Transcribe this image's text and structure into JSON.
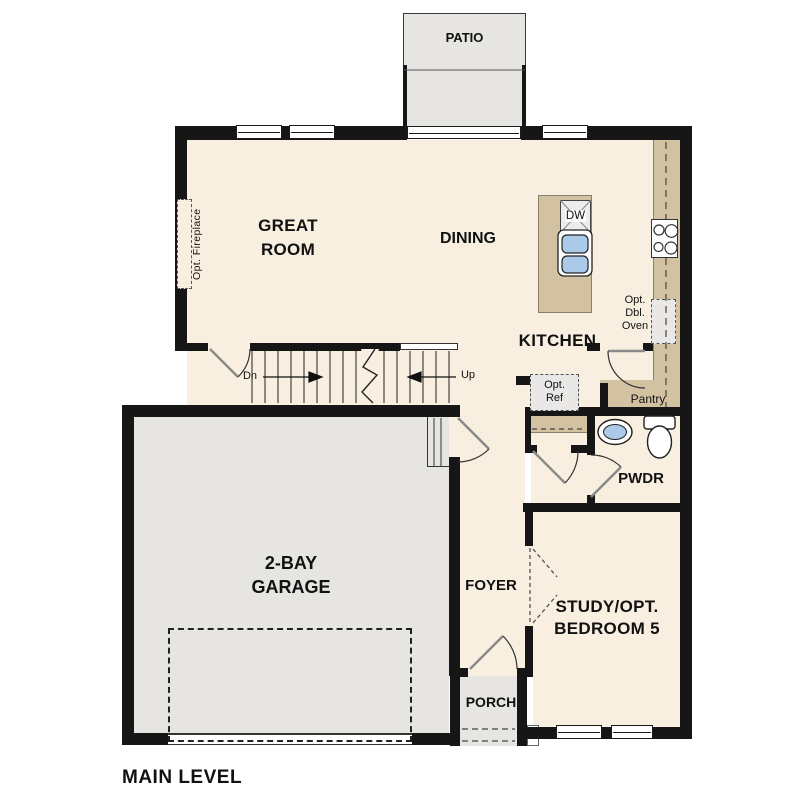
{
  "title": "MAIN LEVEL",
  "colors": {
    "wall": "#161616",
    "floor": "#f8efe1",
    "concrete": "#e6e5e2",
    "counter_tan": "#d2c2a2",
    "sink_blue": "#abc9e9",
    "fixture_gray": "#e9e8e6"
  },
  "rooms": {
    "patio": {
      "label": "PATIO"
    },
    "great_room": {
      "label": "GREAT\nROOM"
    },
    "dining": {
      "label": "DINING"
    },
    "kitchen": {
      "label": "KITCHEN"
    },
    "garage": {
      "label": "2-BAY\nGARAGE"
    },
    "foyer": {
      "label": "FOYER"
    },
    "study": {
      "label": "STUDY/OPT.\nBEDROOM 5"
    },
    "powder": {
      "label": "PWDR"
    },
    "porch": {
      "label": "PORCH"
    },
    "pantry": {
      "label": "Pantry"
    }
  },
  "annotations": {
    "opt_fireplace": "Opt. Fireplace",
    "opt_ref": "Opt.\nRef",
    "opt_dbl_oven": "Opt.\nDbl.\nOven",
    "dishwasher": "DW",
    "stairs_down": "Dn",
    "stairs_up": "Up",
    "plan_title": "MAIN LEVEL"
  }
}
